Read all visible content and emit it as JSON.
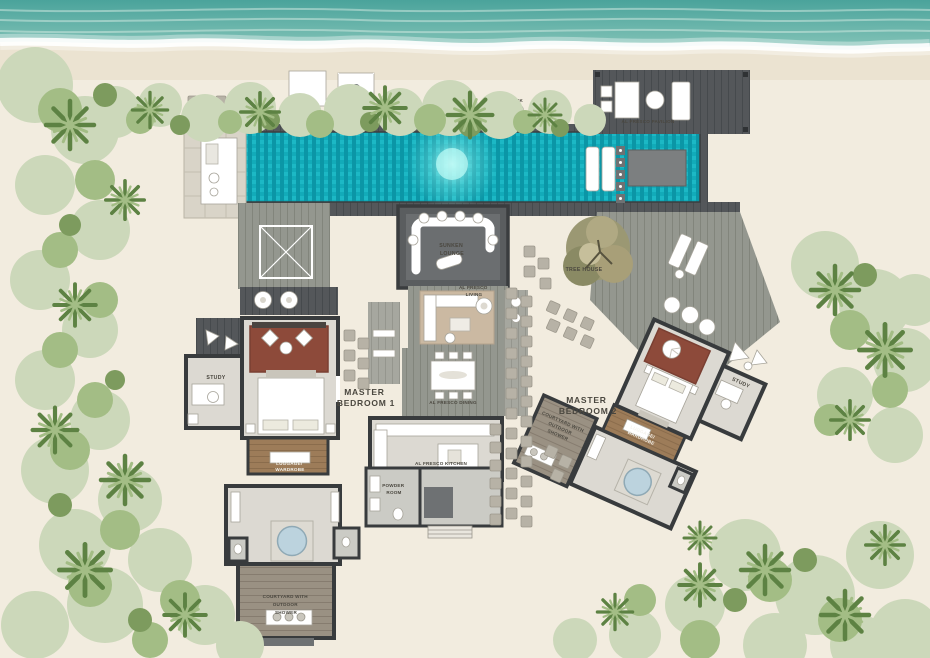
{
  "scene": {
    "type": "resort-villa-floor-plan",
    "setting": "beachfront"
  },
  "rooms": {
    "hammock": {
      "label": "HAMMOCK"
    },
    "pavilion": {
      "label": "AL FRESCO PAVILION"
    },
    "sunken_lounge": {
      "line1": "SUNKEN",
      "line2": "LOUNGE"
    },
    "alfresco_living": {
      "line1": "AL FRESCO",
      "line2": "LIVING"
    },
    "alfresco_dining": {
      "label": "AL FRESCO DINING"
    },
    "alfresco_kitchen": {
      "label": "AL FRESCO KITCHEN"
    },
    "powder_room": {
      "line1": "POWDER",
      "line2": "ROOM"
    },
    "tree_house": {
      "label": "TREE HOUSE"
    },
    "master_bedroom_1": {
      "line1": "MASTER",
      "line2": "BEDROOM 1"
    },
    "master_bedroom_2": {
      "line1": "MASTER",
      "line2": "BEDROOM 2"
    },
    "study_left": {
      "label": "STUDY"
    },
    "study_right": {
      "label": "STUDY"
    },
    "wardrobe_left": {
      "line1": "LUGGAGE/",
      "line2": "WARDROBE"
    },
    "wardrobe_right": {
      "line1": "LUGGAGE/",
      "line2": "WARDROBE"
    },
    "courtyard_left": {
      "line1": "COURTYARD WITH",
      "line2": "OUTDOOR",
      "line3": "SHOWER"
    },
    "courtyard_right": {
      "line1": "COURTYARD WITH",
      "line2": "OUTDOOR",
      "line3": "SHOWER"
    }
  },
  "colors": {
    "ocean_top": "#4aa39b",
    "ocean_bottom": "#85c4b8",
    "foam": "#ffffff",
    "sand": "#f2ecdf",
    "sand_wet": "#ebe3d1",
    "pool": "#0fa7b6",
    "pool_dark": "#0b96a6",
    "pool_mid": "#12abb9",
    "pool_light": "#1cb8c5",
    "deck_dark": "#54575a",
    "deck_mid": "#94978f",
    "deck_light": "#a6a79f",
    "deck_warm": "#9a9183",
    "wall": "#383b3d",
    "floor": "#dcd9d2",
    "floor_stone": "#cbcbc5",
    "rug_red": "#8d4a3a",
    "rug_tan": "#cbb9a2",
    "wood_brown": "#9d7c59",
    "stone": "#b7b2a6",
    "tub": "#bcd3de",
    "veg_pale": "#ccd8ba",
    "veg_mid": "#a3bd85",
    "veg_dark": "#7d9b5e",
    "veg_deep": "#5d8243",
    "veg_olive": "#9b9873",
    "label": "#4a473f",
    "label_light": "#f4f2ec"
  }
}
